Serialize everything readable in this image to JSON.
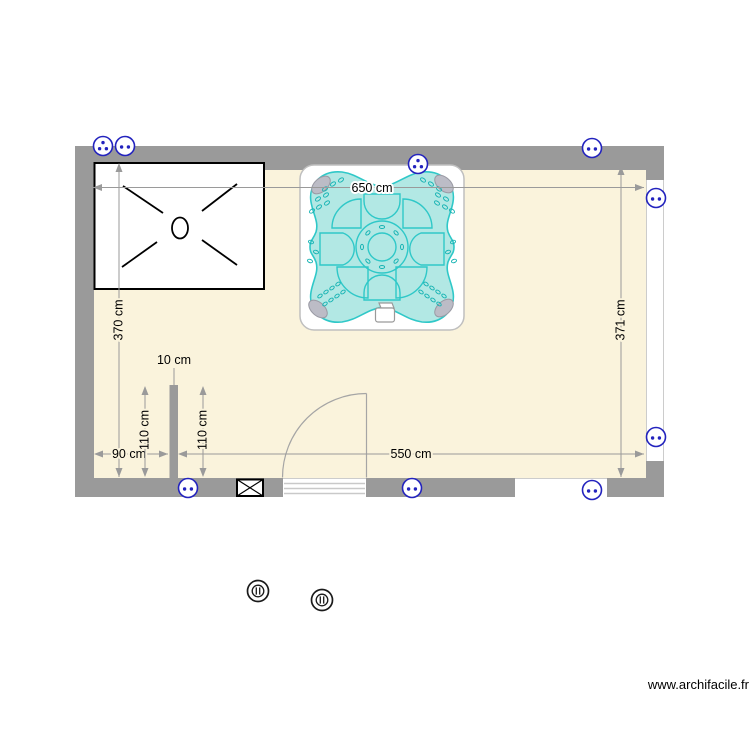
{
  "watermark": {
    "text": "www.archifacile.fr"
  },
  "dimensions": {
    "room_width_top": "650 cm",
    "room_height_left": "370 cm",
    "room_height_right": "371 cm",
    "room_width_bottom": "550 cm",
    "alcove_width": "90 cm",
    "partition_thickness": "10 cm",
    "alcove_inner_height": "110 cm",
    "partition_right_height": "110 cm"
  },
  "legend": {
    "icons": {
      "power-outlet-double-icon": "blue circle with two dots",
      "power-outlet-triple-icon": "blue circle with three dots",
      "ceiling-light-icon": "concentric circles with two bars",
      "vent-grille-icon": "black rectangle with X",
      "door-swing-icon": "quarter-circle arc",
      "shower-icon": "rectangle with corner cross lines and drain oval",
      "spa-icon": "four-lobed hot tub with seats and jets"
    },
    "counts": {
      "outlets_double": 7,
      "outlets_triple": 2,
      "ceiling_lights": 2
    }
  },
  "colors": {
    "wall": "#9a9a9a",
    "floor": "#faf3dc",
    "spa_fill": "#b2e8e4",
    "spa_outline": "#2fc8c8",
    "outlet_blue": "#2323be",
    "dimension_gray": "#9a9a9a"
  }
}
